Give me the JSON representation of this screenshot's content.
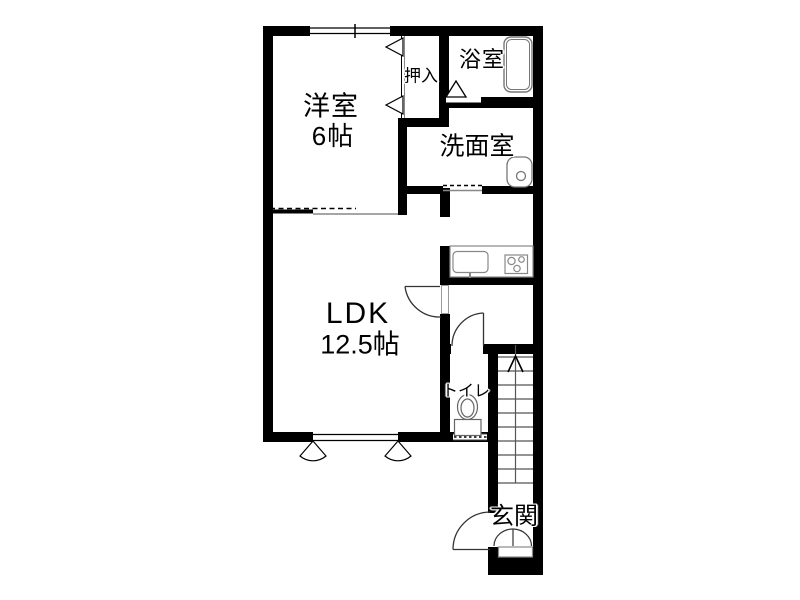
{
  "floorplan": {
    "colors": {
      "background": "#ffffff",
      "wall": "#000000",
      "fixture_line": "#808080",
      "text": "#000000"
    },
    "rooms": [
      {
        "name": "western-room",
        "label": "洋室",
        "size": "6帖"
      },
      {
        "name": "closet",
        "label": "押入",
        "size": ""
      },
      {
        "name": "bathroom",
        "label": "浴室",
        "size": ""
      },
      {
        "name": "washroom",
        "label": "洗面室",
        "size": ""
      },
      {
        "name": "ldk",
        "label": "LDK",
        "size": "12.5帖"
      },
      {
        "name": "toilet",
        "label": "トイレ",
        "size": ""
      },
      {
        "name": "entrance",
        "label": "玄関",
        "size": ""
      }
    ],
    "stairs": {
      "visible_steps": 10,
      "direction": "up"
    }
  }
}
